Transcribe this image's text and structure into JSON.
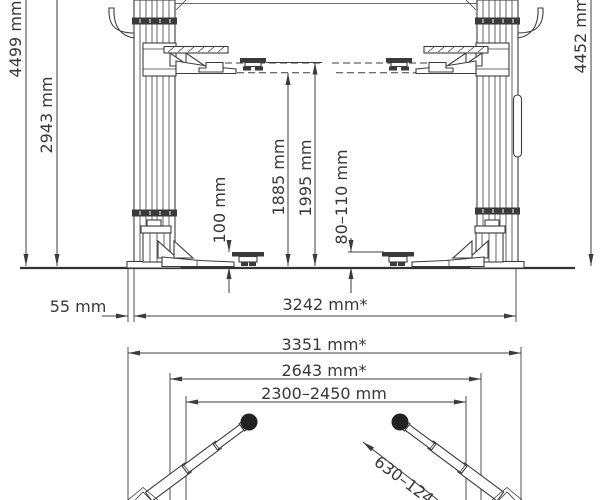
{
  "front_view": {
    "labels": {
      "overall_height_left": "4499 mm",
      "column_height": "2943 mm",
      "overall_height_right": "4452 mm",
      "lifting_height_arm": "1885 mm",
      "lifting_height_pad": "1995 mm",
      "pad_min_height": "100 mm",
      "pad_height_range": "80–110 mm",
      "baseplate_overhang": "55 mm",
      "overall_width": "3242 mm*"
    }
  },
  "top_view": {
    "labels": {
      "overall_width": "3351 mm*",
      "inner_width": "2643 mm*",
      "drive_through_width": "2300–2450 mm",
      "arm_reach": "630–124"
    }
  }
}
